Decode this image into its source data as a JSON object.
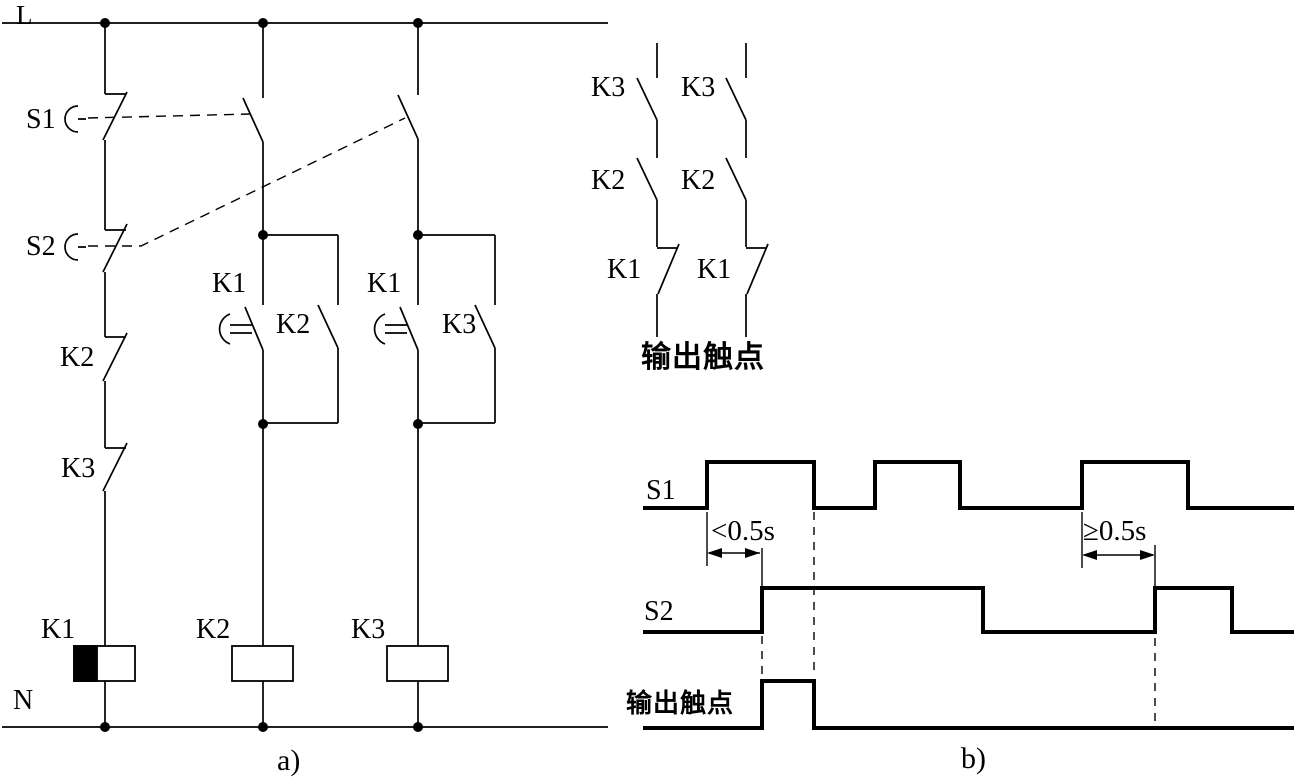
{
  "panel_a": {
    "label": "a)",
    "rail_top": "L",
    "rail_bottom": "N",
    "column1": {
      "button1": "S1",
      "button2": "S2",
      "nc_contact1": "K2",
      "nc_contact2": "K3",
      "coil": "K1"
    },
    "column2": {
      "delay_contact": "K1",
      "parallel_contact": "K2",
      "coil": "K2"
    },
    "column3": {
      "delay_contact": "K1",
      "parallel_contact": "K3",
      "coil": "K3"
    }
  },
  "output_contacts": {
    "title": "输出触点",
    "chain1": {
      "top": "K3",
      "middle": "K2",
      "bottom": "K1"
    },
    "chain2": {
      "top": "K3",
      "middle": "K2",
      "bottom": "K1"
    }
  },
  "panel_b": {
    "label": "b)",
    "annotation_short": "<0.5s",
    "annotation_long": "≥0.5s",
    "waveforms": [
      {
        "label": "S1",
        "x_start": 645,
        "x_end": 1292,
        "y_low": 508,
        "y_high": 462,
        "high_intervals": [
          [
            707,
            814
          ],
          [
            875,
            960
          ],
          [
            1082,
            1188
          ]
        ]
      },
      {
        "label": "S2",
        "x_start": 645,
        "x_end": 1292,
        "y_low": 632,
        "y_high": 588,
        "high_intervals": [
          [
            762,
            983
          ],
          [
            1155,
            1232
          ]
        ]
      },
      {
        "label": "输出触点",
        "x_start": 645,
        "x_end": 1292,
        "y_low": 728,
        "y_high": 681,
        "high_intervals": [
          [
            762,
            814
          ]
        ]
      }
    ]
  }
}
